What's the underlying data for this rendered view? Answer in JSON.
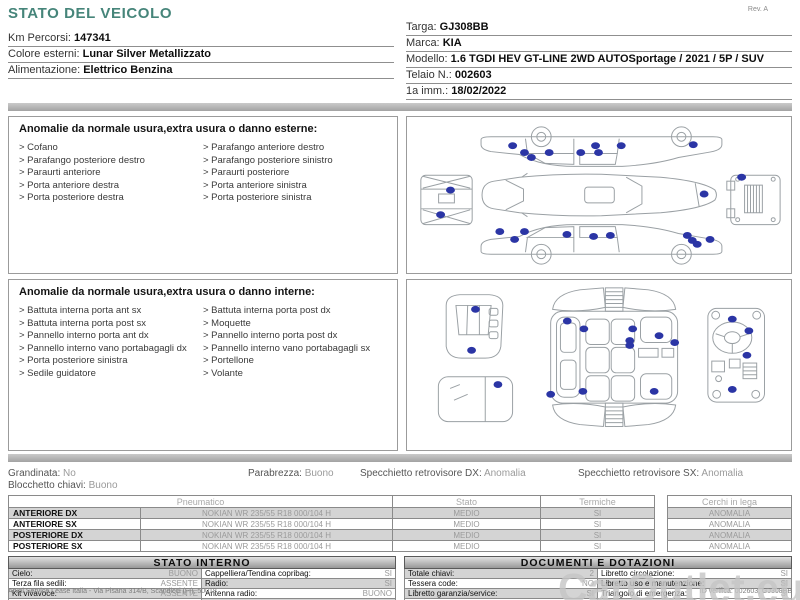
{
  "page": {
    "title": "STATO DEL VEICOLO",
    "rev": "Rev. A",
    "watermark": "CarOutlet.eu",
    "footer": {
      "left": "Arval Service Lease Italia - Via Pisana 314/B, Scandicci (FI), 50018",
      "page_number": "1",
      "right": "ID verifica: 002603, GJ308BB"
    }
  },
  "colors": {
    "accent_teal": "#46857a",
    "marker_blue": "#2b35a5",
    "shaded_cell": "#d4d4d4"
  },
  "vehicle_info_left": [
    {
      "label": "Km Percorsi:",
      "value": "147341"
    },
    {
      "label": "Colore esterni:",
      "value": "Lunar Silver Metallizzato"
    },
    {
      "label": "Alimentazione:",
      "value": "Elettrico Benzina"
    }
  ],
  "vehicle_info_right": [
    {
      "label": "Targa:",
      "value": "GJ308BB"
    },
    {
      "label": "Marca:",
      "value": "KIA"
    },
    {
      "label": "Modello:",
      "value": "1.6 TGDI HEV GT-LINE 2WD AUTOSportage / 2021 / 5P / SUV"
    },
    {
      "label": "Telaio N.:",
      "value": "002603"
    },
    {
      "label": "1a imm.:",
      "value": "18/02/2022"
    }
  ],
  "exterior_section": {
    "heading": "Anomalie da normale usura,extra usura o danno esterne:",
    "bullet": ">",
    "items_left": [
      "Cofano",
      "Parafango posteriore destro",
      "Paraurti anteriore",
      "Porta anteriore destra",
      "Porta posteriore destra"
    ],
    "items_right": [
      "Parafango anteriore destro",
      "Parafango posteriore sinistro",
      "Paraurti posteriore",
      "Porta anteriore sinistra",
      "Porta posteriore sinistra"
    ],
    "markers": [
      [
        105,
        26
      ],
      [
        117,
        33
      ],
      [
        124,
        38
      ],
      [
        142,
        33
      ],
      [
        174,
        33
      ],
      [
        189,
        26
      ],
      [
        192,
        33
      ],
      [
        215,
        26
      ],
      [
        288,
        25
      ],
      [
        299,
        75
      ],
      [
        42,
        71
      ],
      [
        32,
        96
      ],
      [
        337,
        58
      ],
      [
        92,
        113
      ],
      [
        107,
        121
      ],
      [
        117,
        113
      ],
      [
        160,
        116
      ],
      [
        187,
        118
      ],
      [
        204,
        117
      ],
      [
        282,
        117
      ],
      [
        287,
        122
      ],
      [
        305,
        121
      ],
      [
        292,
        126
      ]
    ]
  },
  "interior_section": {
    "heading": "Anomalie da normale usura,extra usura o danno interne:",
    "bullet": ">",
    "items_left": [
      "Battuta interna porta ant sx",
      "Battuta interna porta post sx",
      "Pannello interno porta ant dx",
      "Pannello interno vano portabagagli dx",
      "Porta posteriore sinistra",
      "Sedile guidatore"
    ],
    "items_right": [
      "Battuta interna porta post dx",
      "Moquette",
      "Pannello interno porta post dx",
      "Pannello interno vano portabagagli sx",
      "Portellone",
      "Volante"
    ],
    "markers": [
      [
        66,
        28
      ],
      [
        62,
        70
      ],
      [
        89,
        105
      ],
      [
        160,
        40
      ],
      [
        177,
        48
      ],
      [
        227,
        48
      ],
      [
        254,
        55
      ],
      [
        224,
        60
      ],
      [
        224,
        65
      ],
      [
        270,
        62
      ],
      [
        176,
        112
      ],
      [
        249,
        112
      ],
      [
        143,
        115
      ],
      [
        329,
        38
      ],
      [
        346,
        50
      ],
      [
        344,
        75
      ],
      [
        329,
        110
      ]
    ]
  },
  "condition_summary": {
    "line1": [
      {
        "label": "Grandinata:",
        "value": "No"
      },
      {
        "label": "Parabrezza:",
        "value": "Buono"
      },
      {
        "label": "Specchietto retrovisore DX:",
        "value": "Anomalia"
      },
      {
        "label": "Specchietto retrovisore SX:",
        "value": "Anomalia"
      }
    ],
    "line2": [
      {
        "label": "Blocchetto chiavi:",
        "value": "Buono"
      }
    ]
  },
  "tyre_table": {
    "headers": {
      "pneumatico": "Pneumatico",
      "stato": "Stato",
      "termiche": "Termiche",
      "cerchi": "Cerchi in lega"
    },
    "rows": [
      {
        "position": "ANTERIORE DX",
        "tyre": "NOKIAN WR 235/55 R18 000/104 H",
        "stato": "MEDIO",
        "termiche": "SI",
        "cerchi": "ANOMALIA"
      },
      {
        "position": "ANTERIORE SX",
        "tyre": "NOKIAN WR 235/55 R18 000/104 H",
        "stato": "MEDIO",
        "termiche": "SI",
        "cerchi": "ANOMALIA"
      },
      {
        "position": "POSTERIORE DX",
        "tyre": "NOKIAN WR 235/55 R18 000/104 H",
        "stato": "MEDIO",
        "termiche": "SI",
        "cerchi": "ANOMALIA"
      },
      {
        "position": "POSTERIORE SX",
        "tyre": "NOKIAN WR 235/55 R18 000/104 H",
        "stato": "MEDIO",
        "termiche": "SI",
        "cerchi": "ANOMALIA"
      }
    ]
  },
  "stato_interno": {
    "title": "STATO INTERNO",
    "rows": [
      [
        {
          "label": "Cielo:",
          "value": "BUONO"
        },
        {
          "label": "Cappelliera/Tendina copribag:",
          "value": "SI"
        }
      ],
      [
        {
          "label": "Terza fila sedili:",
          "value": "ASSENTE"
        },
        {
          "label": "Radio:",
          "value": "SI"
        }
      ],
      [
        {
          "label": "Kit vivavoce:",
          "value": "ASSENTE"
        },
        {
          "label": "Antenna radio:",
          "value": "BUONO"
        }
      ],
      [
        {
          "label": "Navigatore:",
          "value": "SI"
        },
        {
          "label": "CD(Navig.):",
          "value": "ASSENTE"
        }
      ]
    ]
  },
  "documenti": {
    "title": "DOCUMENTI E DOTAZIONI",
    "rows": [
      [
        {
          "label": "Totale chiavi:",
          "value": "2"
        },
        {
          "label": "Libretto circolazione:",
          "value": "SI"
        }
      ],
      [
        {
          "label": "Tessera code:",
          "value": "NO"
        },
        {
          "label": "Libretto uso e manutenzione:",
          "value": "SI"
        }
      ],
      [
        {
          "label": "Libretto garanzia/service:",
          "value": "SI"
        },
        {
          "label": "Triangolo di emergenza:",
          "value": "SI"
        }
      ],
      [
        {
          "label": "Catene da neve:",
          "value": "NO"
        },
        {
          "label": "Ruota scorta:",
          "value": "NO"
        },
        {
          "label": "Kit gonfiaggio:",
          "value": "SI"
        }
      ],
      [
        {
          "label": "Codice autoradio:",
          "value": "NO"
        },
        {
          "label": "Cavo elettrico:",
          "value": ""
        }
      ]
    ]
  }
}
